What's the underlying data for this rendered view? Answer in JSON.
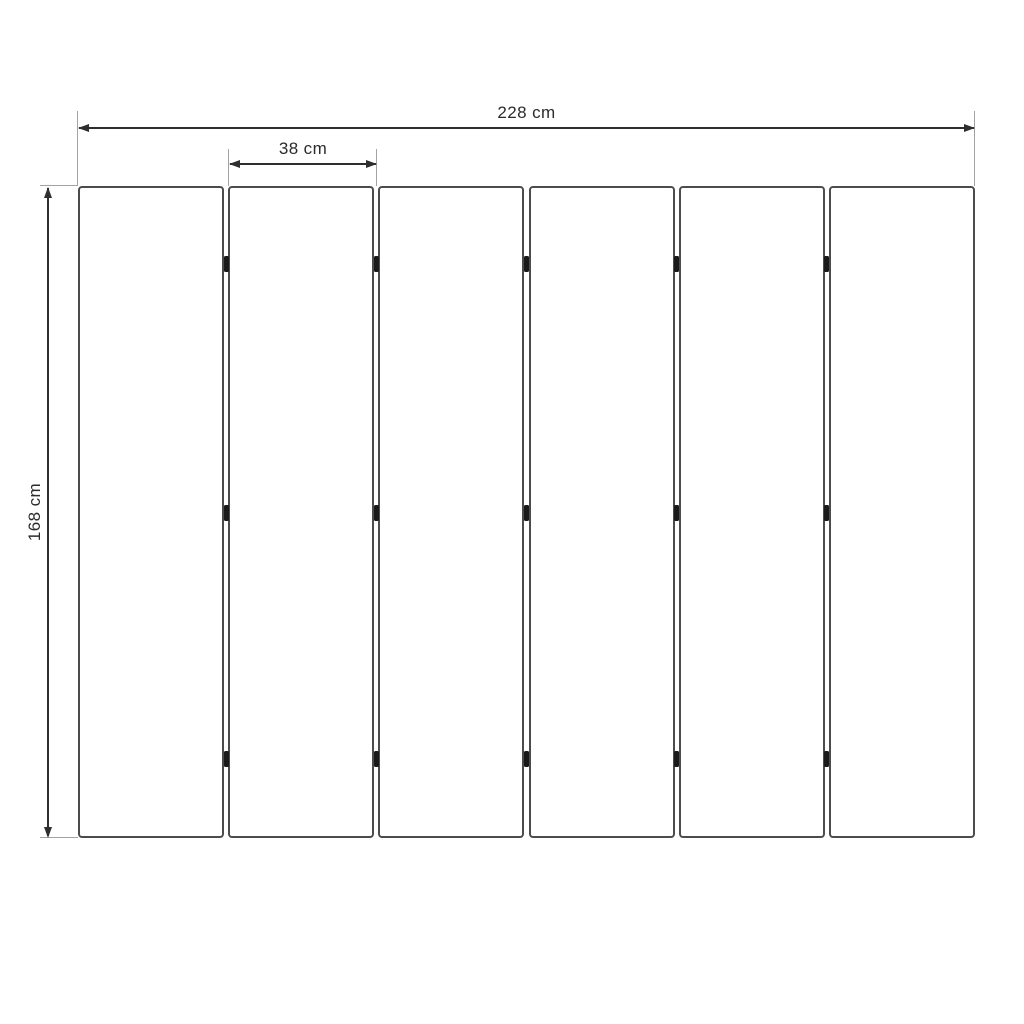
{
  "diagram": {
    "kind": "panel-dimension-drawing",
    "labels": {
      "total_width": "228 cm",
      "panel_width": "38 cm",
      "height": "168 cm"
    },
    "panels": {
      "count": 6,
      "hinge_junctions": 5,
      "hinges_per_junction": 3
    },
    "colors": {
      "background": "#ffffff",
      "panel_border": "#4c4c4c",
      "dimension_line": "#2e2e2e",
      "extension_line": "#a3a3a3",
      "hinge": "#1a1a1a",
      "text": "#2b2b2b"
    }
  }
}
